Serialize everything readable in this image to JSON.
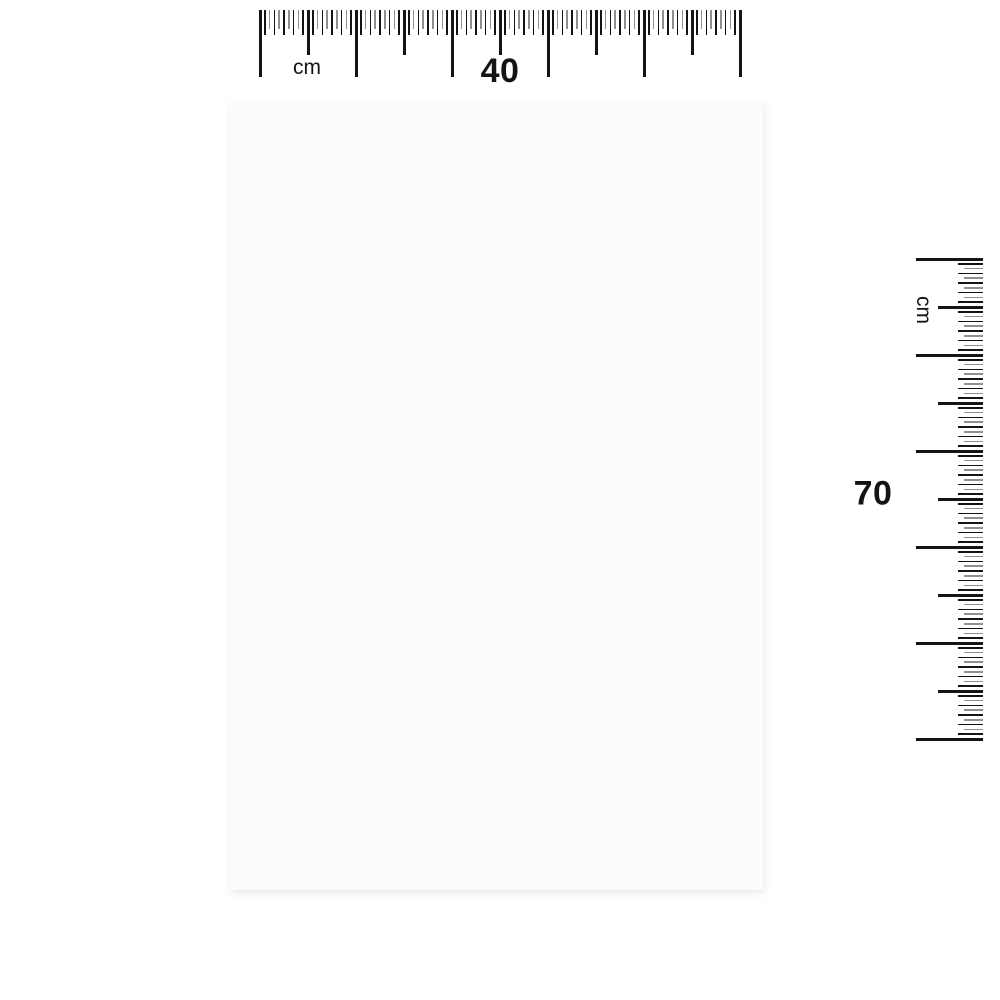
{
  "background_color": "#ffffff",
  "poster": {
    "fill": "#fcfcfc",
    "width_cm": "40",
    "height_cm": "70"
  },
  "rulers": {
    "horizontal": {
      "unit_label": "cm",
      "value_label": "40"
    },
    "vertical": {
      "unit_label": "cm",
      "value_label": "70"
    }
  },
  "ruler_geometry": {
    "intervals": 5,
    "steps_per_interval": 20,
    "step_px": 4.8,
    "major_len": 67,
    "medium_len": 45,
    "minor_long_len": 25,
    "minor_short_len": 19,
    "major_width": 3,
    "minor_width": 1.7,
    "color_dark": "#141414",
    "color_light": "#8f8f8f"
  },
  "label_color": "#141414"
}
